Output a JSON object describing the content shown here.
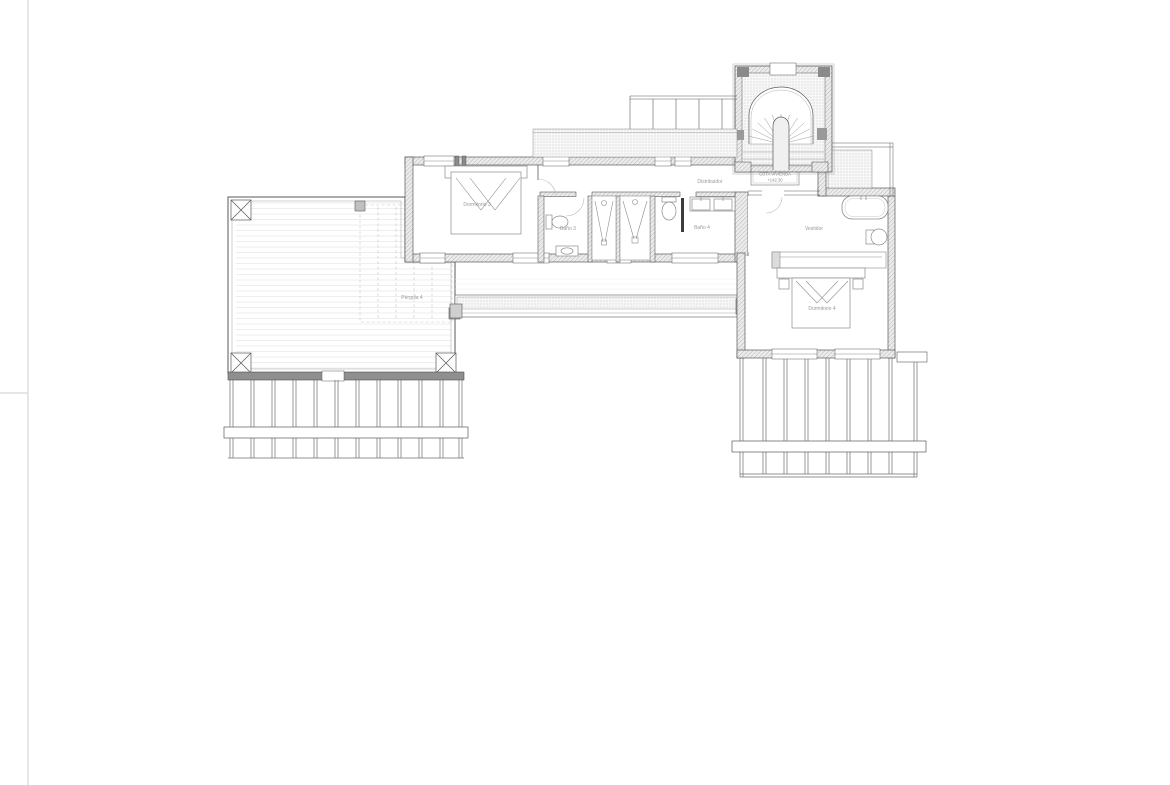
{
  "page": {
    "background": "#ffffff",
    "edge_color": "#dedede"
  },
  "plan": {
    "rooms": {
      "bedroom3": {
        "label": "Dormitorio 3"
      },
      "bath3": {
        "label": "Baño 3"
      },
      "bath4": {
        "label": "Baño 4"
      },
      "hallway": {
        "label": "Distribuidor"
      },
      "dressing_room": {
        "label": "Vestidor"
      },
      "bedroom4": {
        "label": "Dormitorio 4"
      },
      "pergola": {
        "label": "Pérgola 4"
      }
    },
    "elevation_note": {
      "title": "COTA VIVIENDA",
      "value": "+142.30"
    },
    "colors": {
      "wall_line": "#5a5a5a",
      "fixture_line": "#8c8c8c",
      "deck_line": "#dcdcdc",
      "label_text": "#9a9a9a"
    }
  }
}
